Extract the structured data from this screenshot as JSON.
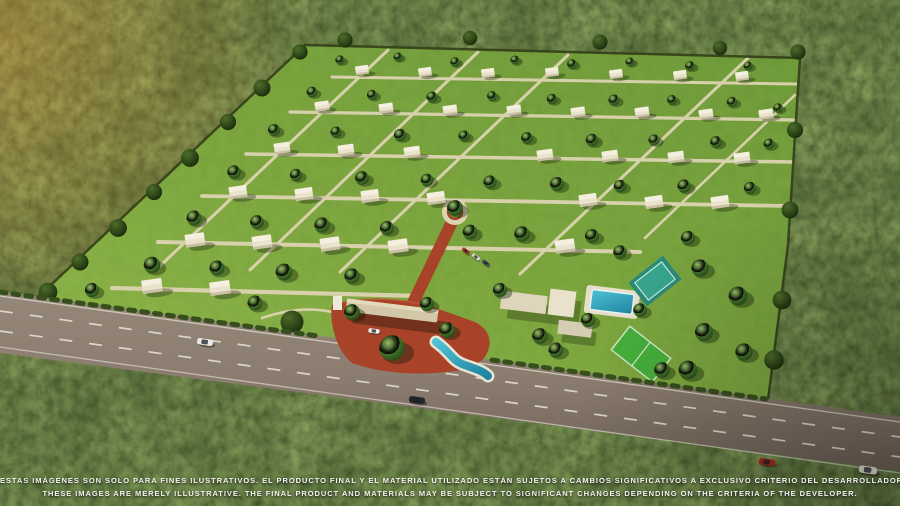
{
  "scene": {
    "type": "aerial-3d-render",
    "subject": "Gated residential masterplan community in dense forest with highway frontage, entrance gate, clubhouse, pool, sports court and soccer field",
    "elements": [
      "forest",
      "residential-lots",
      "houses",
      "internal-streets",
      "roundabout",
      "entrance-plaza",
      "entrance-gate",
      "water-feature",
      "clubhouse",
      "swimming-pool",
      "sports-court",
      "soccer-field",
      "highway",
      "cars",
      "roadside-hedge"
    ],
    "colors": {
      "forest": "#293013",
      "sun_glow": "#ff9a3c",
      "lawn": "#82ad40",
      "street": "#ddd4b2",
      "plaza_red": "#a8432a",
      "house": "#e9e2cc",
      "pool": "#35a8bf",
      "court": "#2c8f7e",
      "field": "#47b13c",
      "asphalt": "#82746a",
      "marking": "#e9e5da",
      "text": "#ffffff"
    }
  },
  "disclaimer": {
    "line1": "ESTAS IMÁGENES SON SOLO PARA FINES ILUSTRATIVOS. EL PRODUCTO FINAL Y EL MATERIAL UTILIZADO ESTÁN SUJETOS A CAMBIOS SIGNIFICATIVOS A EXCLUSIVO CRITERIO DEL DESARROLLADOR.",
    "line2": "THESE IMAGES ARE MERELY ILLUSTRATIVE. THE FINAL PRODUCT AND MATERIALS MAY BE SUBJECT TO SIGNIFICANT CHANGES DEPENDING ON THE CRITERIA OF THE DEVELOPER."
  }
}
